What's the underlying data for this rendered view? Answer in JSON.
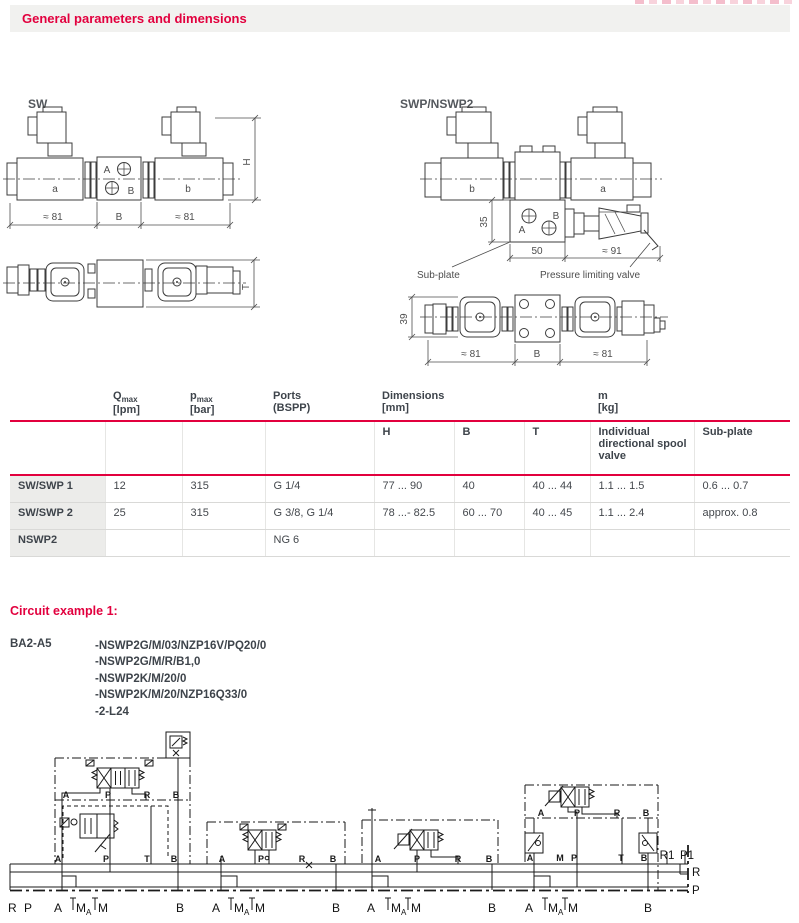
{
  "page": {
    "header_title": "General parameters and dimensions"
  },
  "colors": {
    "accent": "#e2003e"
  },
  "drawings": {
    "sw": {
      "title": "SW",
      "coil_a": "a",
      "coil_b": "b",
      "port_a": "A",
      "port_b": "B",
      "dim_h": "H",
      "dim_t": "T",
      "dim_left": "≈ 81",
      "dim_mid": "B",
      "dim_right": "≈ 81"
    },
    "swp": {
      "title": "SWP/NSWP2",
      "coil_b": "b",
      "coil_a": "a",
      "port_a": "A",
      "port_b": "B",
      "dim_35": "35",
      "dim_50": "50",
      "dim_91": "≈ 91",
      "dim_39": "39",
      "dim_left": "≈ 81",
      "dim_mid": "B",
      "dim_right": "≈ 81",
      "label_subplate": "Sub-plate",
      "label_plv": "Pressure limiting valve"
    }
  },
  "table": {
    "headers": {
      "q_main": "Q",
      "q_sub": "max",
      "q_unit": "[lpm]",
      "p_main": "p",
      "p_sub": "max",
      "p_unit": "[bar]",
      "ports_1": "Ports",
      "ports_2": "(BSPP)",
      "dims_1": "Dimensions",
      "dims_2": "[mm]",
      "m_1": "m",
      "m_2": "[kg]",
      "h": "H",
      "b": "B",
      "t": "T",
      "valve": "Individual directional spool valve",
      "subplate": "Sub-plate"
    },
    "rows": [
      {
        "name": "SW/SWP 1",
        "qmax": "12",
        "pmax": "315",
        "ports": "G 1/4",
        "h": "77 ... 90",
        "b": "40",
        "t": "40 ... 44",
        "m_valve": "1.1 ... 1.5",
        "m_subplate": "0.6 ... 0.7"
      },
      {
        "name": "SW/SWP 2",
        "qmax": "25",
        "pmax": "315",
        "ports": "G 3/8, G 1/4",
        "h": "78 ...- 82.5",
        "b": "60 ... 70",
        "t": "40 ... 45",
        "m_valve": "1.1 ... 2.4",
        "m_subplate": "approx. 0.8"
      },
      {
        "name": "NSWP2",
        "qmax": "",
        "pmax": "",
        "ports": "NG 6",
        "h": "",
        "b": "",
        "t": "",
        "m_valve": "",
        "m_subplate": ""
      }
    ]
  },
  "circuit": {
    "title": "Circuit example 1:",
    "model": "BA2-A5",
    "items": [
      "-NSWP2G/M/03/NZP16V/PQ20/0",
      "-NSWP2G/M/R/B1,0",
      "-NSWP2K/M/20/0",
      "-NSWP2K/M/20/NZP16Q33/0",
      "-2-L24"
    ],
    "labels": {
      "A": "A",
      "B": "B",
      "P": "P",
      "R": "R",
      "T": "T",
      "M": "M",
      "Msub": "A",
      "R1": "R1",
      "P1": "P1"
    }
  }
}
